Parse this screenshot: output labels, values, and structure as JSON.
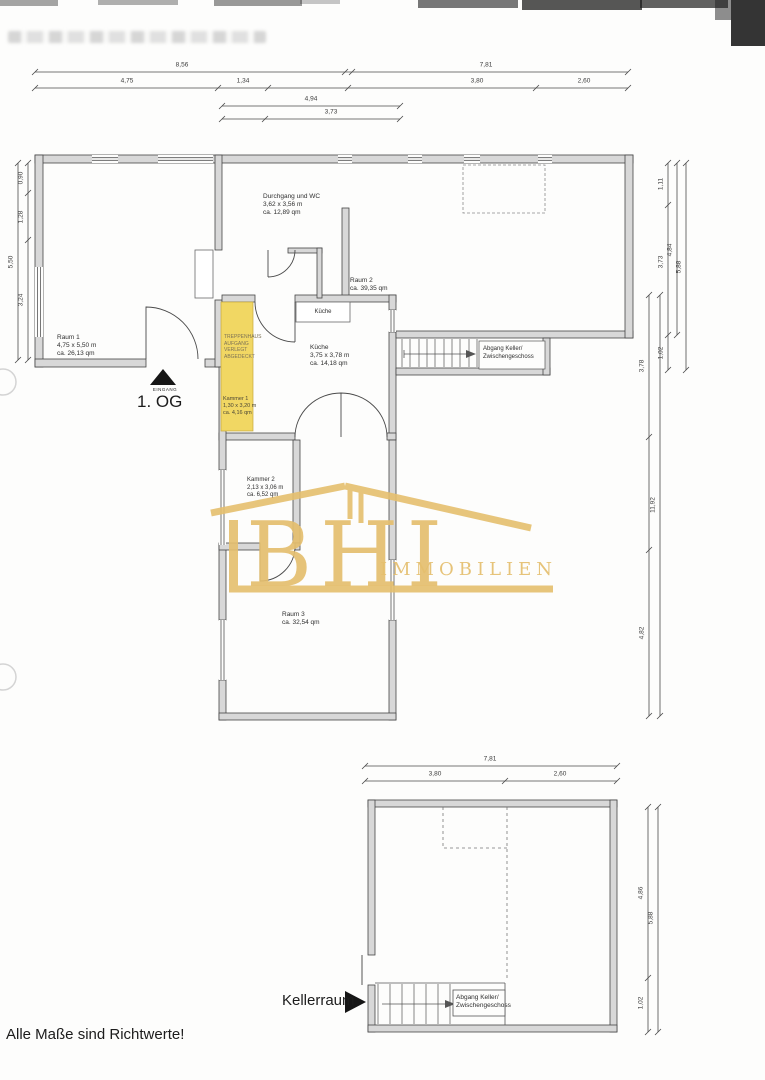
{
  "footer": {
    "note": "Alle Maße sind Richtwerte!"
  },
  "logo": {
    "initials": "BHI",
    "word": "IMMOBILIEN",
    "color": "#e5bf6e"
  },
  "plan_og": {
    "floor": "1. OG",
    "entrance": "EINGANG",
    "rooms": {
      "raum1": {
        "name": "Raum 1",
        "dims": "4,75 x 5,50 m",
        "area": "ca. 26,13 qm"
      },
      "durchgang": {
        "name": "Durchgang und WC",
        "dims": "3,62 x 3,56 m",
        "area": "ca. 12,89 qm"
      },
      "raum2": {
        "name": "Raum 2",
        "area": "ca. 39,35 qm"
      },
      "kueche_counter": "Küche",
      "kueche": {
        "name": "Küche",
        "dims": "3,75 x 3,78 m",
        "area": "ca. 14,18 qm"
      },
      "kammer1": {
        "name": "Kammer 1",
        "dims": "1,30 x 3,20 m",
        "area": "ca. 4,16 qm",
        "note1": "TREPPENHAUS",
        "note2": "AUFGANG",
        "note3": "VERLEGT",
        "note4": "ABGEDECKT"
      },
      "kammer2": {
        "name": "Kammer 2",
        "dims": "2,13 x 3,06 m",
        "area": "ca. 6,52 qm"
      },
      "raum3": {
        "name": "Raum 3",
        "area": "ca. 32,54 qm"
      },
      "abgang": {
        "line1": "Abgang Keller/",
        "line2": "Zwischengeschoss"
      }
    },
    "dims": {
      "t1a": "8,56",
      "t1b": "7,81",
      "t2a": "4,75",
      "t2b": "1,34",
      "t2c": "3,80",
      "t2d": "2,60",
      "t3": "4,94",
      "t4": "3,73",
      "l1": "0,90",
      "l2": "1,28",
      "l3": "3,24",
      "l_total": "5,50",
      "r1": "1,11",
      "r2": "3,73",
      "r3": "1,02",
      "r_sub": "4,84",
      "r_total": "5,88",
      "r4": "3,78",
      "r_wing_total": "11,92",
      "r5": "4,82"
    }
  },
  "plan_keller": {
    "label": "Kellerraum",
    "abgang": {
      "line1": "Abgang Keller/",
      "line2": "Zwischengeschoss"
    },
    "dims": {
      "t1": "7,81",
      "t2a": "3,80",
      "t2b": "2,60",
      "r1": "4,86",
      "r2": "1,02",
      "r_total": "5,88"
    }
  }
}
